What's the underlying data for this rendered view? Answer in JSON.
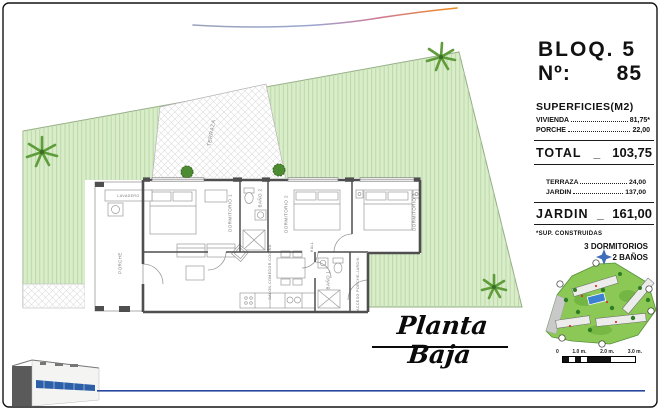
{
  "header": {
    "block": "BLOQ. 5",
    "number_label": "Nº:",
    "number_value": "85"
  },
  "surfaces": {
    "title": "SUPERFICIES(M2)",
    "built_rows": [
      {
        "label": "VIVIENDA",
        "value": "81,75*"
      },
      {
        "label": "PORCHE",
        "value": "22,00"
      }
    ],
    "total_label": "TOTAL",
    "total_separator": "_",
    "total_value": "103,75",
    "outdoor_rows": [
      {
        "label": "TERRAZA",
        "value": "24,00"
      },
      {
        "label": "JARDIN",
        "value": "137,00"
      }
    ],
    "garden_label": "JARDIN",
    "garden_separator": "_",
    "garden_value": "161,00",
    "footnote": "*SUP. CONSTRUIDAS",
    "program": [
      "3 DORMITORIOS",
      "2 BAÑOS"
    ]
  },
  "plan": {
    "title": "Planta Baja",
    "rooms": {
      "terraza": "TERRAZA",
      "porche": "PORCHE",
      "lavadero": "LAVADERO",
      "dormitorio1": "DORMITORIO 1",
      "dormitorio2": "DORMITORIO 2",
      "dormitorio3": "DORMITORIO 3",
      "bano1": "BAÑO 1",
      "bano2": "BAÑO 2",
      "salon": "SALON-COMEDOR-COCINA",
      "hall": "HALL",
      "acceso": "ACCESO PORCHE-JARDIN"
    }
  },
  "scalebar": {
    "labels": [
      "0",
      "1.0 m.",
      "2.0 m.",
      "3.0 m."
    ]
  },
  "colors": {
    "garden": "#d9edca",
    "garden_stripe": "#b7d6a2",
    "palm": "#5f9c3a",
    "wall": "#4f4f4f",
    "brand_blue": "#27479e",
    "map_green": "#8cc856",
    "pool_blue": "#3d7fd0",
    "swoosh_orange": "#ef8a1a"
  }
}
